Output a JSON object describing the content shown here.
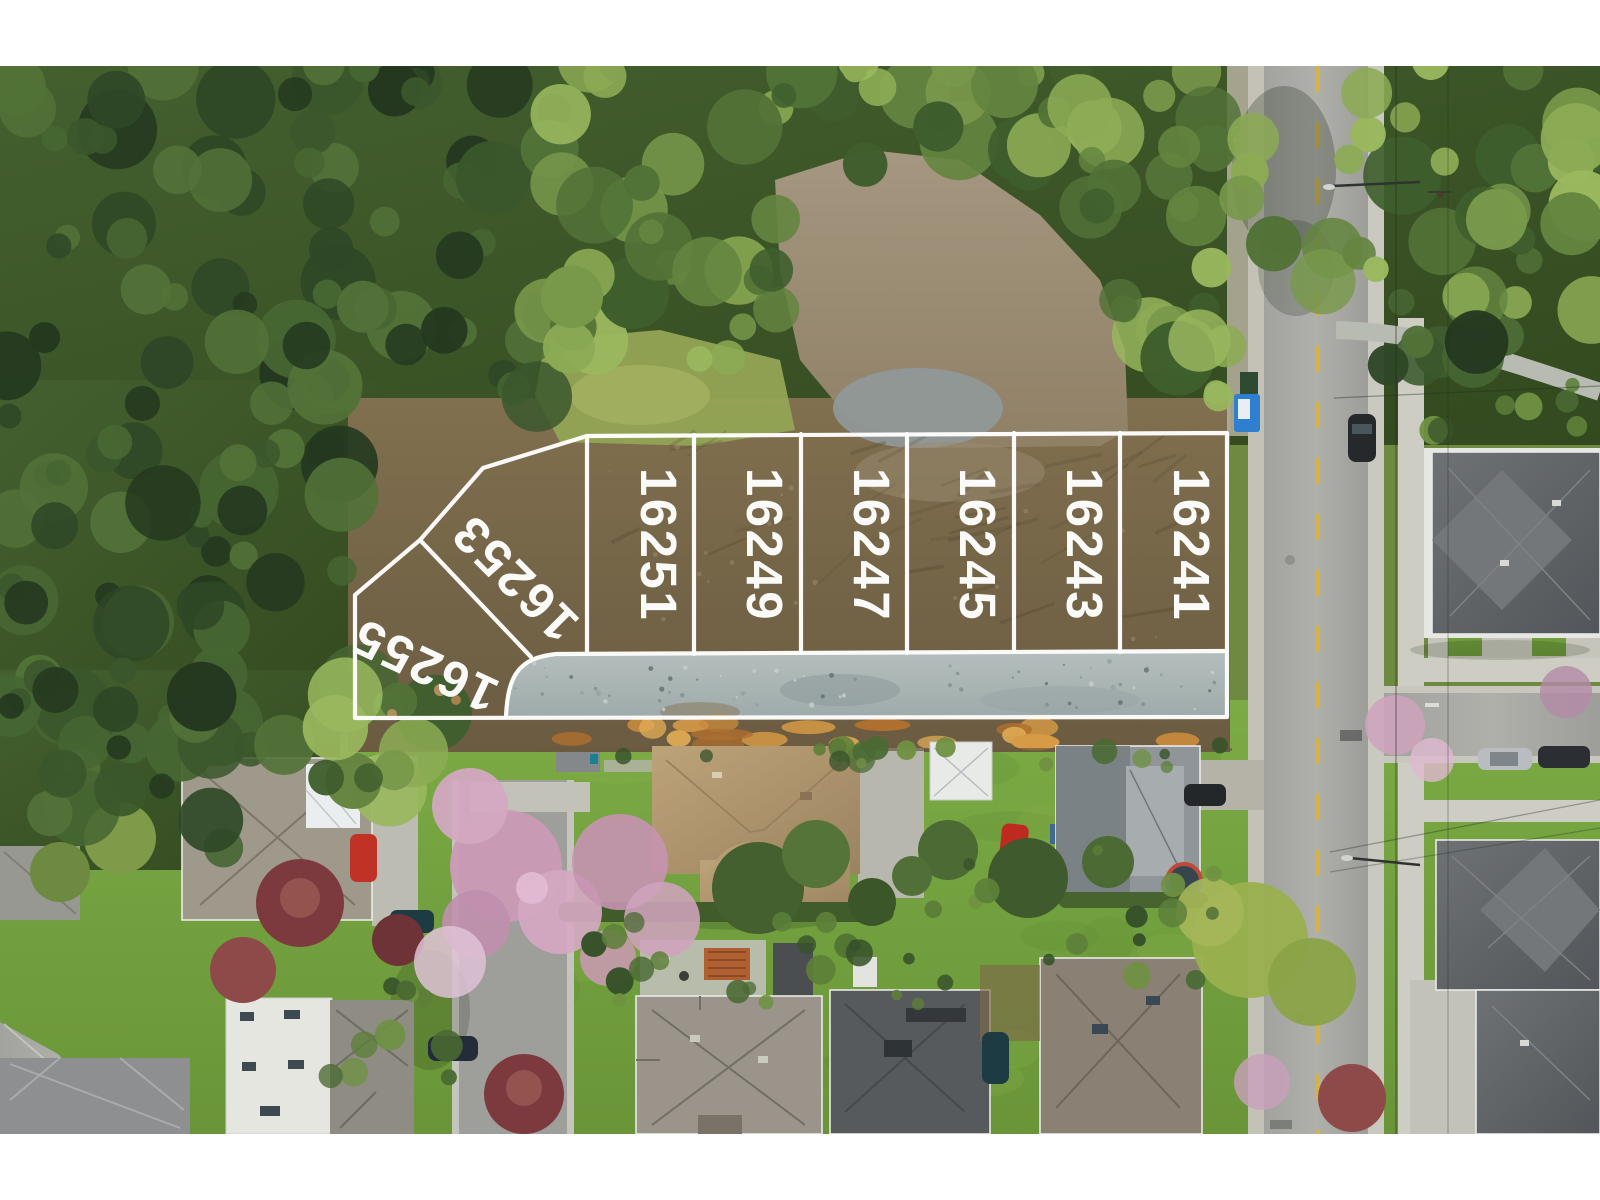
{
  "overlay": {
    "line_color": "#ffffff",
    "lots": [
      {
        "number": "16255"
      },
      {
        "number": "16253"
      },
      {
        "number": "16251"
      },
      {
        "number": "16249"
      },
      {
        "number": "16247"
      },
      {
        "number": "16245"
      },
      {
        "number": "16243"
      },
      {
        "number": "16241"
      }
    ]
  },
  "palette": {
    "overlay_white": "#ffffff",
    "forest_green": "#4a6a33",
    "cleared_lot_brown": "#7a6a4e",
    "dirt_clearing_tan": "#9d8f78",
    "gravel_road_gray": "#adb8b8",
    "street_asphalt": "#a6a6a2",
    "lane_line_yellow": "#d9b33e",
    "lawn_green": "#76a243",
    "blossom_pink": "#cf9fb9",
    "maple_red": "#7c3a3e",
    "letterbox_white": "#ffffff"
  }
}
